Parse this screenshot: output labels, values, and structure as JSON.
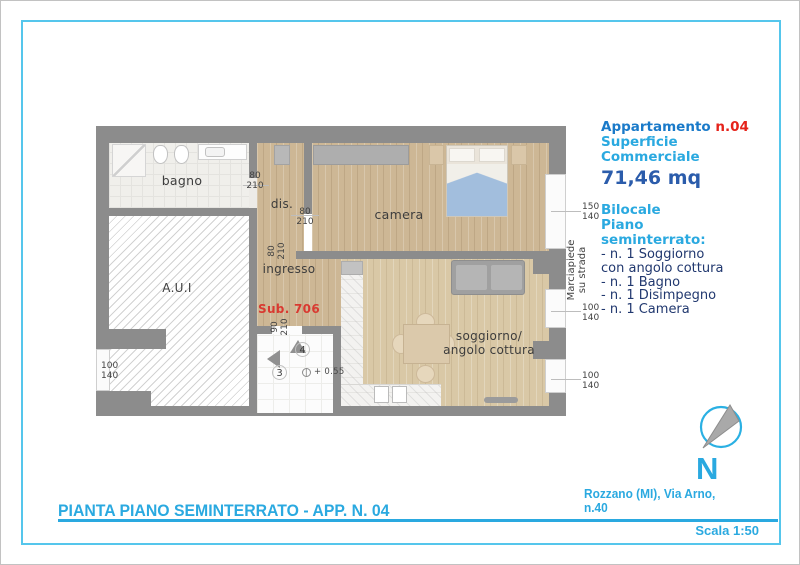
{
  "colors": {
    "accent_cyan": "#2aa9e0",
    "accent_blue": "#1a7ac9",
    "accent_red": "#e5231b",
    "accent_navy": "#21386f",
    "area_blue": "#2b5cab",
    "wall_gray": "#8c8c8c"
  },
  "info_panel": {
    "apartment_label": "Appartamento",
    "apartment_number": "n.04",
    "surface_line1": "Superficie",
    "surface_line2": "Commerciale",
    "area": "71,46 mq",
    "layout_line1": "Bilocale",
    "layout_line2": "Piano",
    "layout_line3": "seminterrato:",
    "features": [
      "- n. 1 Soggiorno",
      "con angolo cottura",
      "- n. 1 Bagno",
      "- n. 1 Disimpegno",
      "- n. 1 Camera"
    ]
  },
  "plan": {
    "rooms": {
      "bagno": "bagno",
      "dis": "dis.",
      "camera": "camera",
      "ingresso": "ingresso",
      "aui": "A.U.I",
      "soggiorno_line1": "soggiorno/",
      "soggiorno_line2": "angolo cottura"
    },
    "sub_unit": "Sub. 706",
    "sidewalk_line1": "Marciapiede",
    "sidewalk_line2": "su strada",
    "stairs": {
      "upper": "4",
      "lower": "3",
      "level": "+ 0.55"
    },
    "dims": {
      "bagno_door": {
        "w": "80",
        "h": "210"
      },
      "dis_door": {
        "w": "80",
        "h": "210"
      },
      "ingresso_door": {
        "w": "80",
        "h": "210"
      },
      "stairs_door": {
        "w": "90",
        "h": "210"
      },
      "camera_window": {
        "w": "150",
        "h": "140"
      },
      "soggiorno_window_upper": {
        "w": "100",
        "h": "140"
      },
      "soggiorno_window_lower": {
        "w": "100",
        "h": "140"
      },
      "aui_window": {
        "w": "100",
        "h": "140"
      }
    }
  },
  "compass": {
    "north": "N"
  },
  "footer": {
    "title": "PIANTA PIANO SEMINTERRATO - APP. N. 04",
    "address_line1": "Rozzano (MI), Via Arno,",
    "address_line2": "n.40",
    "scale": "Scala 1:50"
  }
}
